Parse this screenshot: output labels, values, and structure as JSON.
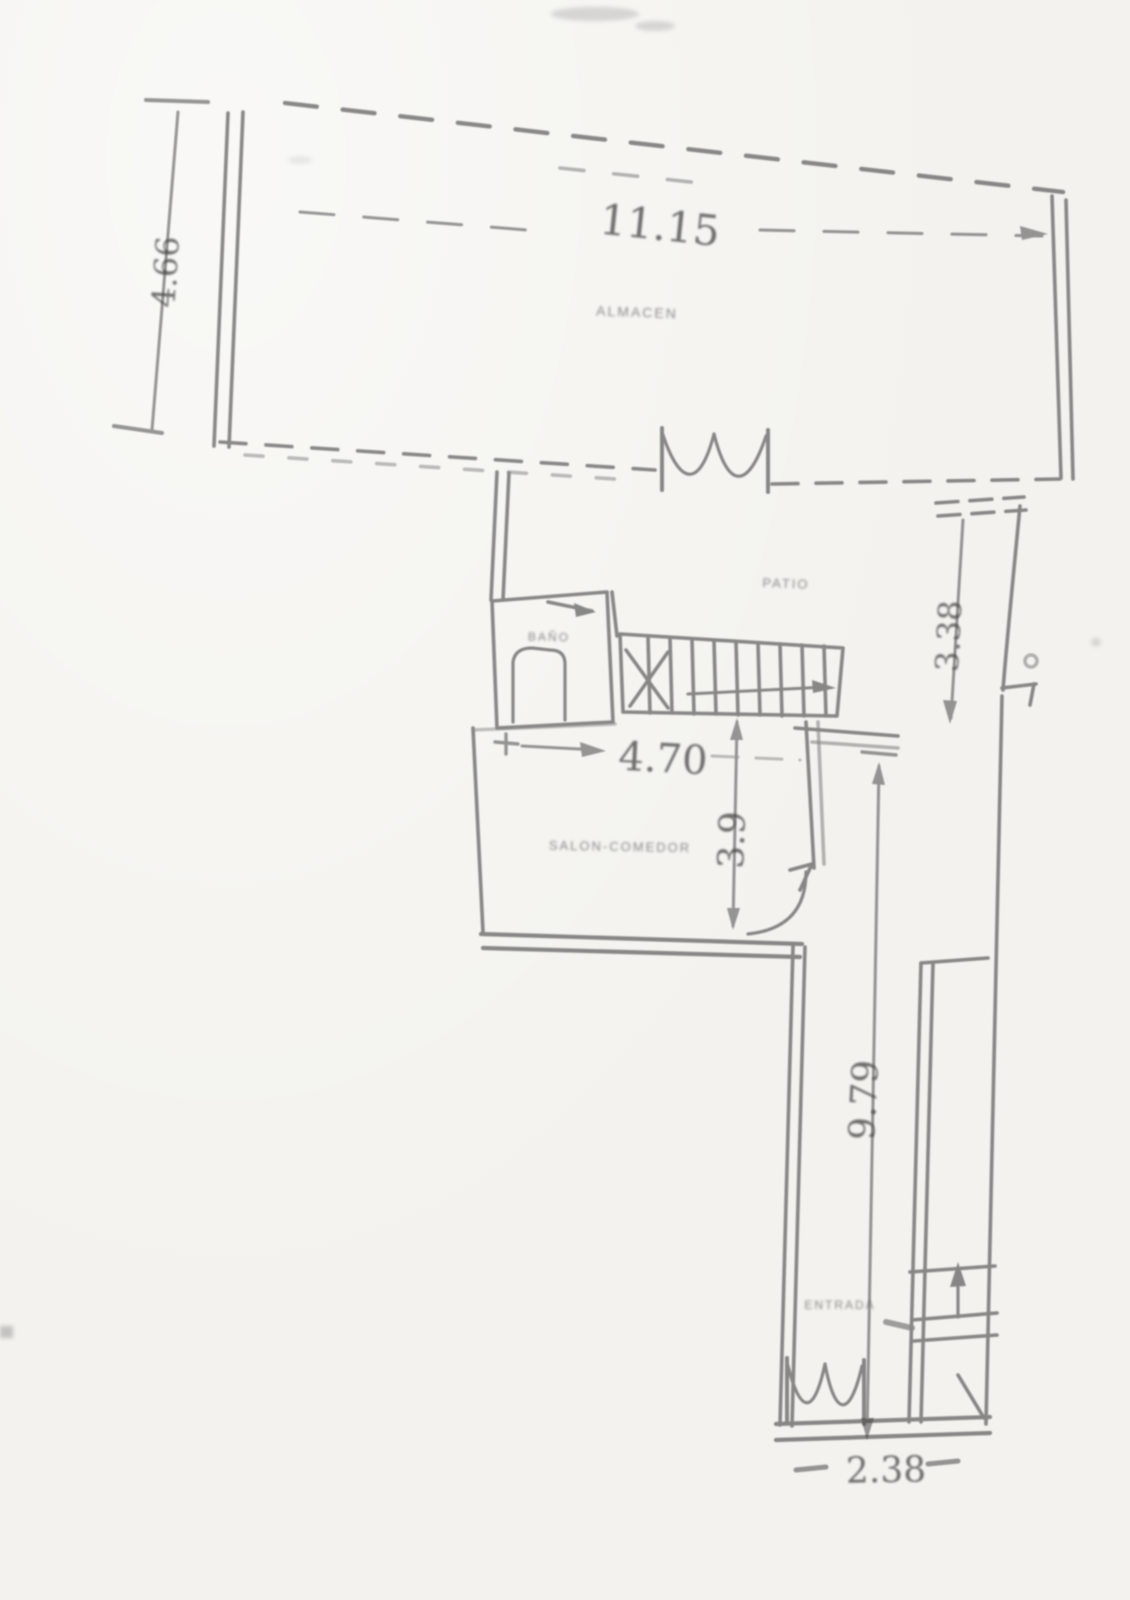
{
  "document": {
    "kind": "scanned floor plan",
    "background_color": "#f3f2ee",
    "ink_color": "#454545"
  },
  "dimensions": {
    "top_width": "11.15",
    "left_height": "4.66",
    "upper_right_height": "3.38",
    "middle_width": "4.70",
    "salon_height": "3.9",
    "corridor_height": "9.79",
    "entrance_width": "2.38"
  },
  "rooms": {
    "top_room": "ALMACEN",
    "patio": "PATIO",
    "bath": "BAÑO",
    "salon": "SALON-COMEDOR",
    "entrance": "ENTRADA"
  }
}
